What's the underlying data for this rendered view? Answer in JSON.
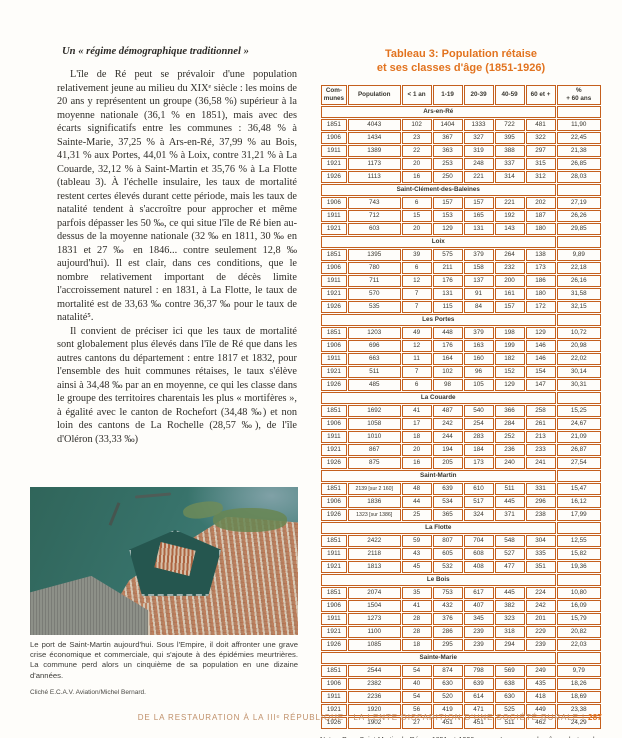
{
  "left_column": {
    "heading": "Un « régime démographique traditionnel »",
    "para1": "L'île de Ré peut se prévaloir d'une population relativement jeune au milieu du XIXᵉ siècle : les moins de 20 ans y représentent un groupe (36,58 %) supérieur à la moyenne nationale (36,1 % en 1851), mais avec des écarts significatifs entre les communes : 36,48 % à Sainte-Marie, 37,25 % à Ars-en-Ré, 37,99 % au Bois, 41,31 % aux Portes, 44,01 % à Loix, contre 31,21 % à La Couarde, 32,12 % à Saint-Martin et 35,76 % à La Flotte (tableau 3). À l'échelle insulaire, les taux de mortalité restent certes élevés durant cette période, mais les taux de natalité tendent à s'accroître pour approcher et même parfois dépasser les 50 ‰, ce qui situe l'île de Ré bien au-dessus de la moyenne nationale (32 ‰ en 1811, 30 ‰ en 1831 et 27 ‰ en 1846... contre seulement 12,8 ‰ aujourd'hui). Il est clair, dans ces conditions, que le nombre relativement important de décès limite l'accroissement naturel : en 1831, à La Flotte, le taux de mortalité est de 33,63 ‰ contre 36,37 ‰ pour le taux de natalité⁵.",
    "para2": "Il convient de préciser ici que les taux de mortalité sont globalement plus élevés dans l'île de Ré que dans les autres cantons du département : entre 1817 et 1832, pour l'ensemble des huit communes rétaises, le taux s'élève ainsi à 34,48 ‰ par an en moyenne, ce qui les classe dans le groupe des territoires charentais les plus « mortifères », à égalité avec le canton de Rochefort (34,48 ‰) et non loin des cantons de La Rochelle (28,57 ‰), de l'île d'Oléron (33,33 ‰)",
    "photo_caption": "Le port de Saint-Martin aujourd'hui. Sous l'Empire, il doit affronter une grave crise économique et commerciale, qui s'ajoute à des épidémies meurtrières. La commune perd alors un cinquième de sa population en une dizaine d'années.",
    "photo_credit": "Cliché E.C.A.V. Aviation/Michel Bernard."
  },
  "table": {
    "title_line1": "Tableau 3: Population rétaise",
    "title_line2": "et ses classes d'âge (1851-1926)",
    "headers": [
      "Com-\nmunes",
      "Population",
      "< 1 an",
      "1-19",
      "20-39",
      "40-59",
      "60 et +",
      "%\n+ 60 ans"
    ],
    "accent_color": "#e2731f",
    "border_color": "#c45f1d",
    "sections": [
      {
        "name": "Ars-en-Ré",
        "rows": [
          [
            "1851",
            "4043",
            "102",
            "1404",
            "1333",
            "722",
            "481",
            "11,90"
          ],
          [
            "1906",
            "1434",
            "23",
            "367",
            "327",
            "395",
            "322",
            "22,45"
          ],
          [
            "1911",
            "1389",
            "22",
            "363",
            "319",
            "388",
            "297",
            "21,38"
          ],
          [
            "1921",
            "1173",
            "20",
            "253",
            "248",
            "337",
            "315",
            "26,85"
          ],
          [
            "1926",
            "1113",
            "16",
            "250",
            "221",
            "314",
            "312",
            "28,03"
          ]
        ]
      },
      {
        "name": "Saint-Clément-des-Baleines",
        "rows": [
          [
            "1906",
            "743",
            "6",
            "157",
            "157",
            "221",
            "202",
            "27,19"
          ],
          [
            "1911",
            "712",
            "15",
            "153",
            "165",
            "192",
            "187",
            "26,26"
          ],
          [
            "1921",
            "603",
            "20",
            "129",
            "131",
            "143",
            "180",
            "29,85"
          ]
        ]
      },
      {
        "name": "Loix",
        "rows": [
          [
            "1851",
            "1395",
            "39",
            "575",
            "379",
            "264",
            "138",
            "9,89"
          ],
          [
            "1906",
            "780",
            "6",
            "211",
            "158",
            "232",
            "173",
            "22,18"
          ],
          [
            "1911",
            "711",
            "12",
            "176",
            "137",
            "200",
            "186",
            "26,16"
          ],
          [
            "1921",
            "570",
            "7",
            "131",
            "91",
            "161",
            "180",
            "31,58"
          ],
          [
            "1926",
            "535",
            "7",
            "115",
            "84",
            "157",
            "172",
            "32,15"
          ]
        ]
      },
      {
        "name": "Les Portes",
        "rows": [
          [
            "1851",
            "1203",
            "49",
            "448",
            "379",
            "198",
            "129",
            "10,72"
          ],
          [
            "1906",
            "696",
            "12",
            "176",
            "163",
            "199",
            "146",
            "20,98"
          ],
          [
            "1911",
            "663",
            "11",
            "164",
            "160",
            "182",
            "146",
            "22,02"
          ],
          [
            "1921",
            "511",
            "7",
            "102",
            "96",
            "152",
            "154",
            "30,14"
          ],
          [
            "1926",
            "485",
            "6",
            "98",
            "105",
            "129",
            "147",
            "30,31"
          ]
        ]
      },
      {
        "name": "La Couarde",
        "rows": [
          [
            "1851",
            "1692",
            "41",
            "487",
            "540",
            "366",
            "258",
            "15,25"
          ],
          [
            "1906",
            "1058",
            "17",
            "242",
            "254",
            "284",
            "261",
            "24,67"
          ],
          [
            "1911",
            "1010",
            "18",
            "244",
            "283",
            "252",
            "213",
            "21,09"
          ],
          [
            "1921",
            "867",
            "20",
            "194",
            "184",
            "236",
            "233",
            "26,87"
          ],
          [
            "1926",
            "875",
            "16",
            "205",
            "173",
            "240",
            "241",
            "27,54"
          ]
        ]
      },
      {
        "name": "Saint-Martin",
        "rows": [
          [
            "1851",
            "2139 [sur 2 160]",
            "48",
            "639",
            "610",
            "511",
            "331",
            "15,47"
          ],
          [
            "1906",
            "1836",
            "44",
            "534",
            "517",
            "445",
            "296",
            "16,12"
          ],
          [
            "1926",
            "1323 [sur 1386]",
            "25",
            "365",
            "324",
            "371",
            "238",
            "17,99"
          ]
        ]
      },
      {
        "name": "La Flotte",
        "rows": [
          [
            "1851",
            "2422",
            "59",
            "807",
            "704",
            "548",
            "304",
            "12,55"
          ],
          [
            "1911",
            "2118",
            "43",
            "605",
            "608",
            "527",
            "335",
            "15,82"
          ],
          [
            "1921",
            "1813",
            "45",
            "532",
            "408",
            "477",
            "351",
            "19,36"
          ]
        ]
      },
      {
        "name": "Le Bois",
        "rows": [
          [
            "1851",
            "2074",
            "35",
            "753",
            "617",
            "445",
            "224",
            "10,80"
          ],
          [
            "1906",
            "1504",
            "41",
            "432",
            "407",
            "382",
            "242",
            "16,09"
          ],
          [
            "1911",
            "1273",
            "28",
            "376",
            "345",
            "323",
            "201",
            "15,79"
          ],
          [
            "1921",
            "1100",
            "28",
            "286",
            "239",
            "318",
            "229",
            "20,82"
          ],
          [
            "1926",
            "1085",
            "18",
            "295",
            "239",
            "294",
            "239",
            "22,03"
          ]
        ]
      },
      {
        "name": "Sainte-Marie",
        "rows": [
          [
            "1851",
            "2544",
            "54",
            "874",
            "798",
            "569",
            "249",
            "9,79"
          ],
          [
            "1906",
            "2382",
            "40",
            "630",
            "639",
            "638",
            "435",
            "18,26"
          ],
          [
            "1911",
            "2236",
            "54",
            "520",
            "614",
            "630",
            "418",
            "18,69"
          ],
          [
            "1921",
            "1920",
            "56",
            "419",
            "471",
            "525",
            "449",
            "23,38"
          ],
          [
            "1926",
            "1902",
            "27",
            "451",
            "451",
            "511",
            "462",
            "24,29"
          ]
        ]
      }
    ],
    "nota": "Nota : Pour Saint-Martin-de-Ré en 1851 et 1926, nous n'avons pas les âges de tous les habitants, d'où l'inadéquation avec le chiffre total de la population. Données établies d'après les recensements de population."
  },
  "footer": {
    "text": "DE LA RESTAURATION À LA IIIᵉ RÉPUBLIQUE : LA LENTE DISPARITION D'UNE SOCIÉTÉ RURALE |",
    "page_number": "287"
  }
}
